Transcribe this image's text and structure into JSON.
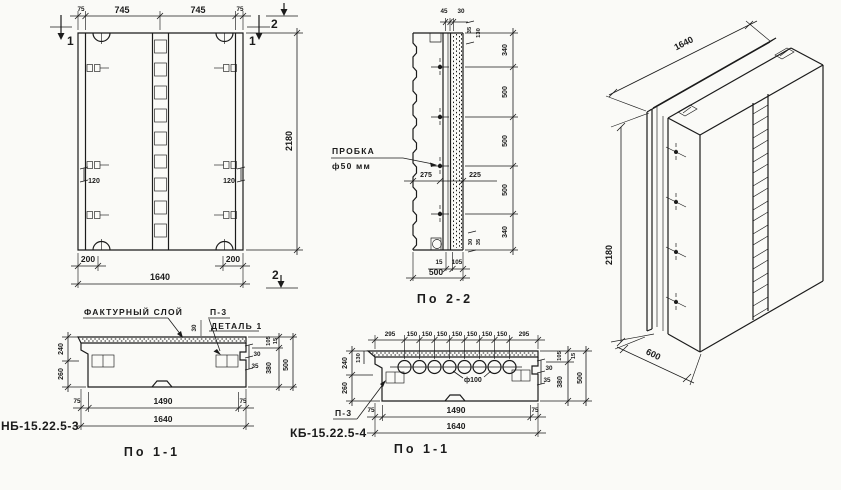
{
  "front_view": {
    "top_dims": [
      "75",
      "745",
      "745",
      "75"
    ],
    "right_dim": "2180",
    "bottom_dims_small": [
      "200",
      "200"
    ],
    "bottom_dim_total": "1640",
    "anchor_dim_left": "120",
    "anchor_dim_right": "120",
    "section_mark_1_left": "1",
    "section_mark_1_right": "1",
    "section_mark_2_top": "2",
    "section_mark_2_bottom": "2"
  },
  "section_2_2": {
    "title": "По 2-2",
    "plug_label_line1": "ПРОБКА",
    "plug_label_line2": "ф50 мм",
    "top_dims": [
      "45",
      "30"
    ],
    "top_right_dims": [
      "35",
      "130"
    ],
    "right_chain_dims": [
      "340",
      "500",
      "500",
      "500",
      "340"
    ],
    "bottom_right_dims": [
      "30",
      "35"
    ],
    "mid_dims": [
      "275",
      "225"
    ],
    "bottom_dims": [
      "15",
      "105"
    ],
    "bottom_total": "500"
  },
  "section_nb": {
    "mark": "НБ-15.22.5-3",
    "title": "По 1-1",
    "facture_label": "ФАКТУРНЫЙ СЛОЙ",
    "p3_label": "П-3",
    "detail_label": "ДЕТАЛЬ 1",
    "facture_dim": "30",
    "left_dims": [
      "240",
      "260"
    ],
    "right_step_dims": [
      "30",
      "35"
    ],
    "right_dims": [
      "105",
      "15",
      "380",
      "500"
    ],
    "bottom_dims": [
      "75",
      "1490",
      "75"
    ],
    "bottom_total": "1640"
  },
  "section_kb": {
    "mark": "КБ-15.22.5-4",
    "title": "По 1-1",
    "p3_label": "П-3",
    "hole_label": "ф100",
    "layer_dim": "130",
    "top_dims": [
      "295",
      "150",
      "150",
      "150",
      "150",
      "150",
      "150",
      "150",
      "295"
    ],
    "left_dims": [
      "240",
      "260"
    ],
    "right_step_dims": [
      "30",
      "35"
    ],
    "right_dims": [
      "105",
      "15",
      "380",
      "500"
    ],
    "bottom_dims": [
      "75",
      "1490",
      "75"
    ],
    "bottom_total": "1640"
  },
  "axonometric": {
    "length_dim": "1640",
    "height_dim": "2180",
    "depth_dim": "600"
  }
}
